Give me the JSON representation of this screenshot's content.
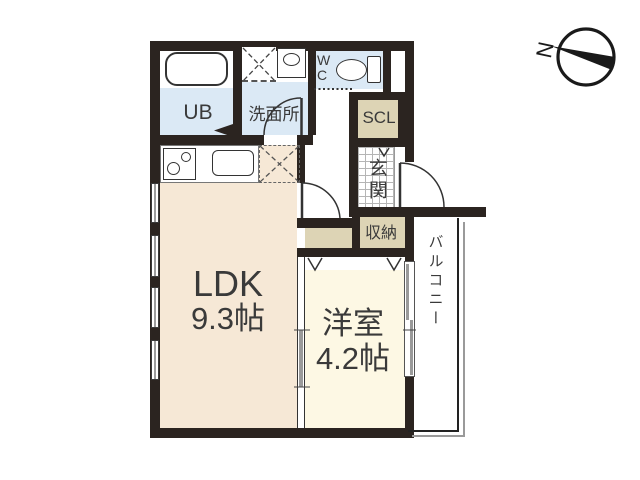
{
  "floorplan": {
    "compass": {
      "label": "N"
    },
    "rooms": {
      "ub": {
        "label": "UB"
      },
      "washroom": {
        "label": "洗面所"
      },
      "wc": {
        "lines": [
          "W",
          "C"
        ]
      },
      "scl": {
        "label": "SCL"
      },
      "genkan": {
        "label": "玄関"
      },
      "storage": {
        "label": "収納"
      },
      "ldk": {
        "label": "LDK",
        "size": "9.3帖"
      },
      "western_room": {
        "label": "洋室",
        "size": "4.2帖"
      },
      "balcony": {
        "label": "バルコニー"
      }
    },
    "colors": {
      "wall": "#2b2420",
      "wet_area": "#dbe9f5",
      "closet": "#ddd4b5",
      "ldk_floor": "#f6e8d6",
      "western_floor": "#fdf8e4"
    }
  }
}
